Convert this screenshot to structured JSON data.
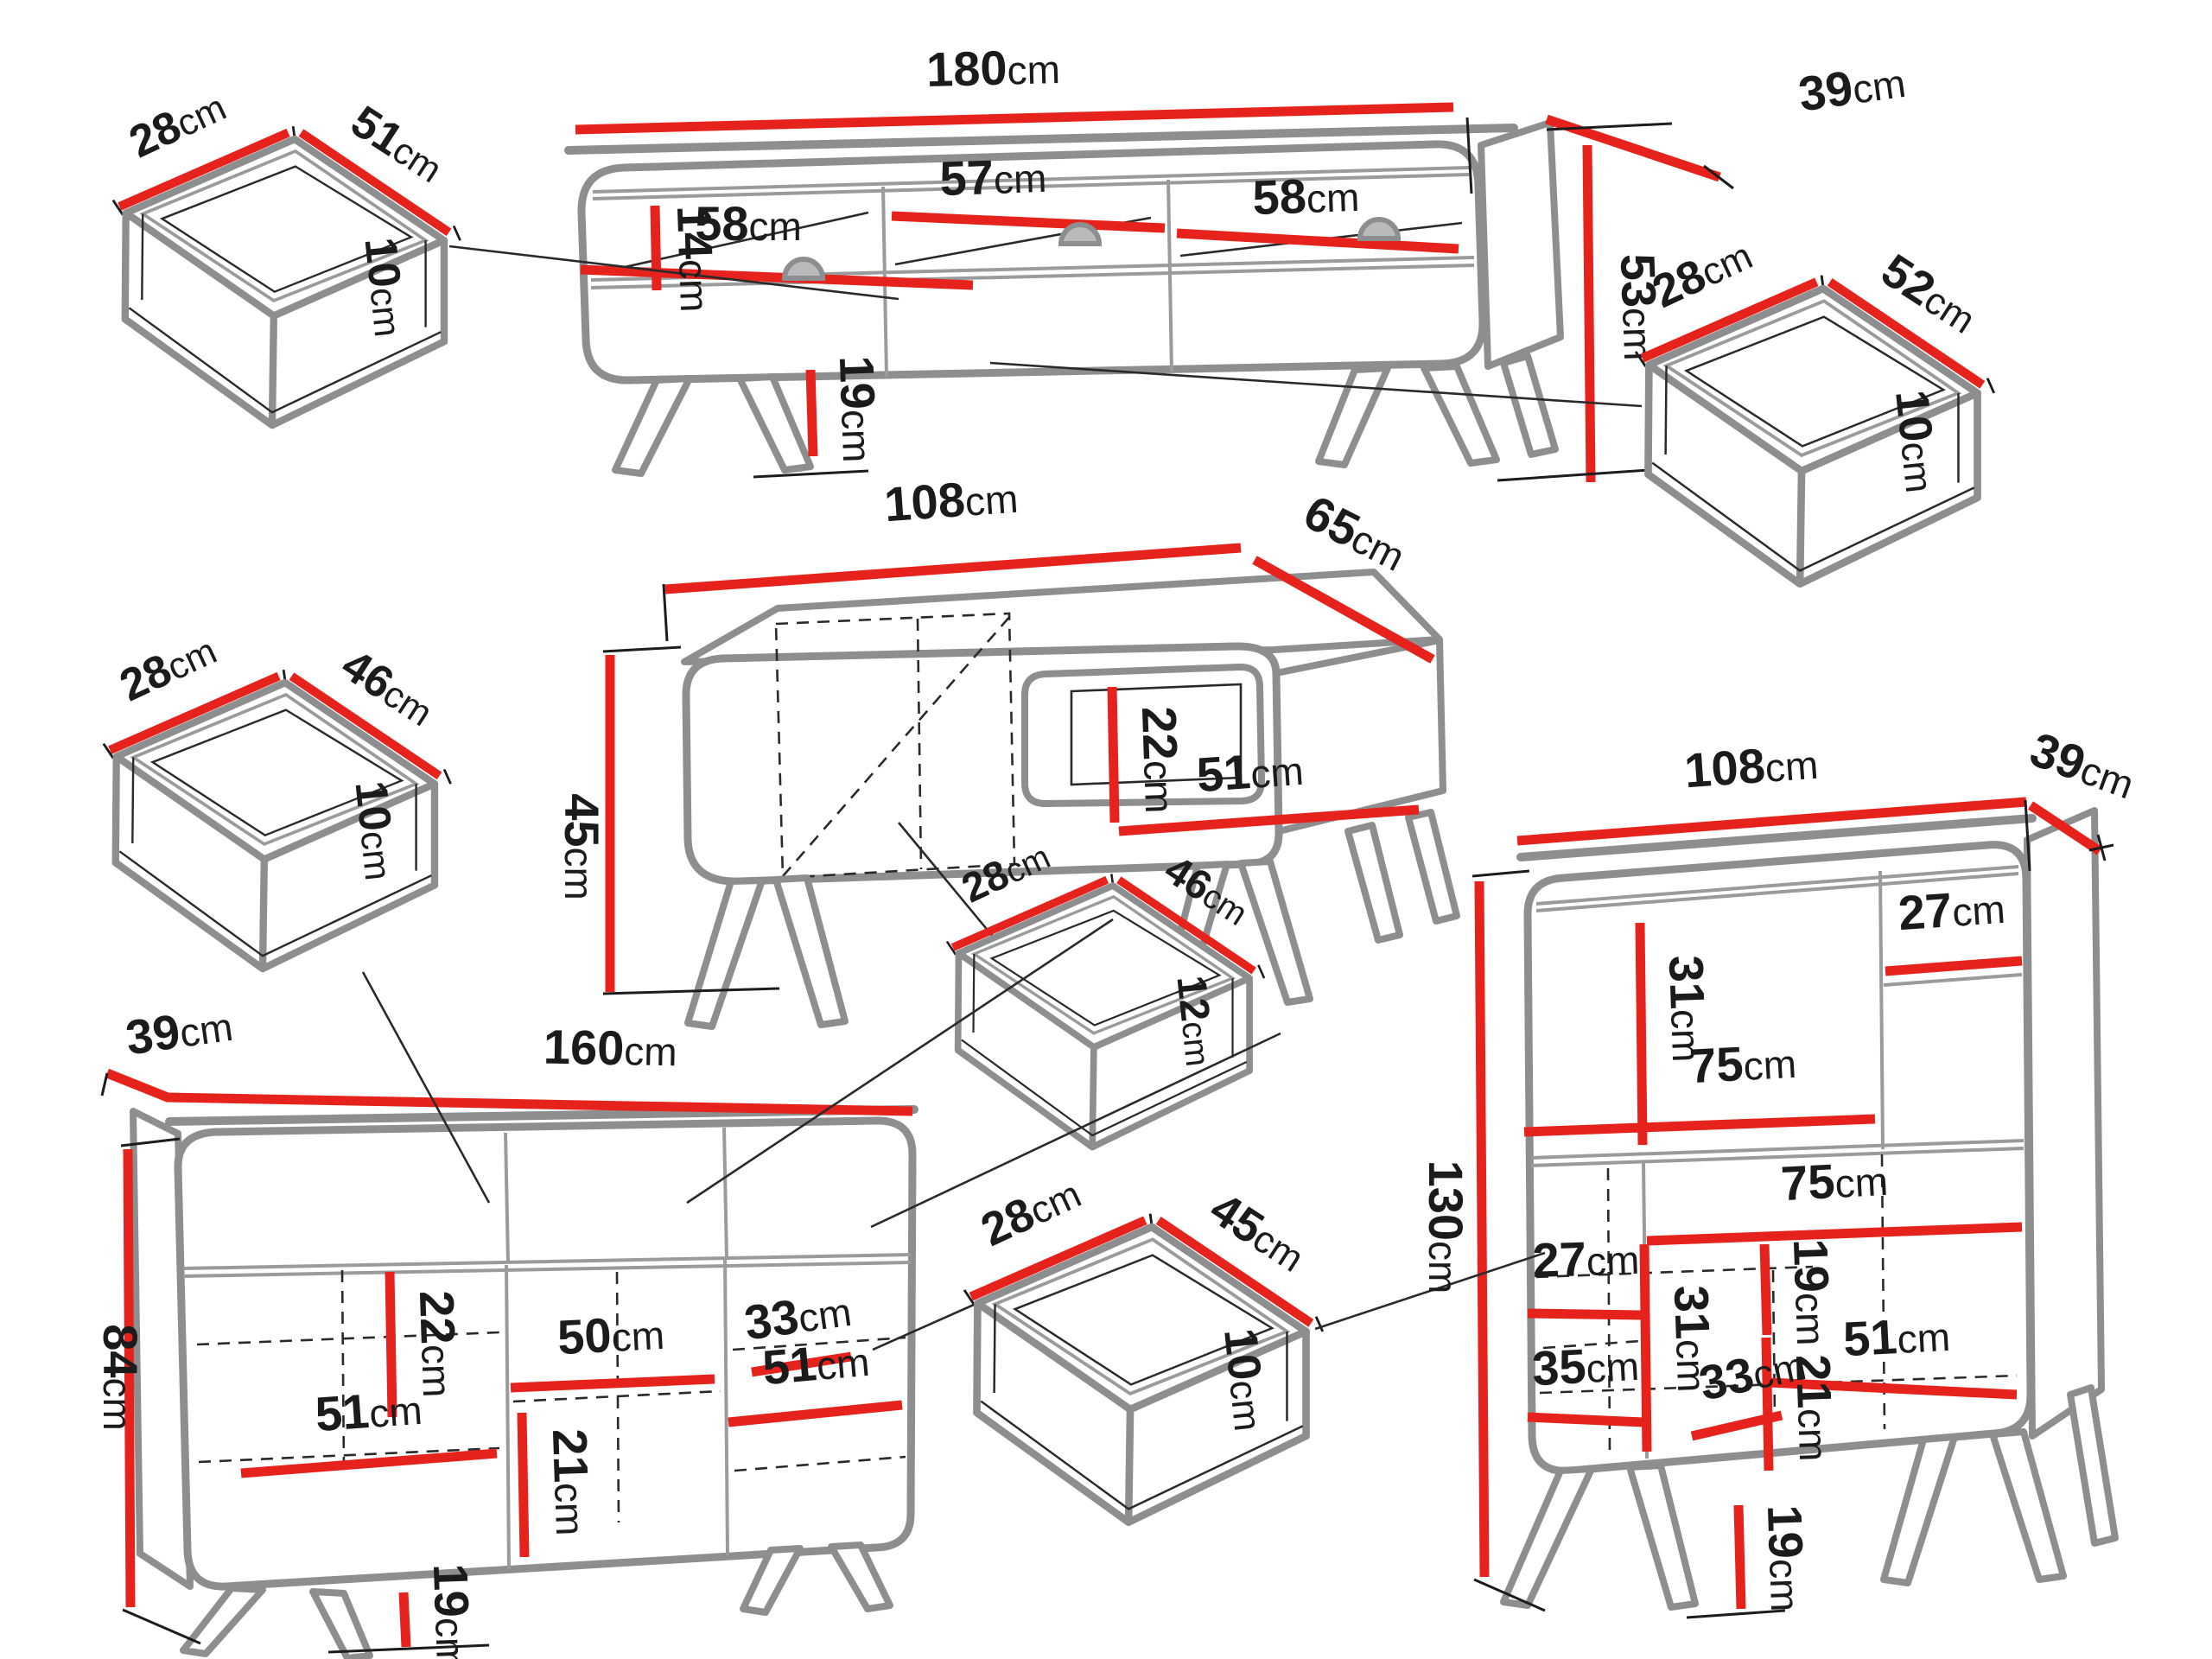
{
  "diagram": {
    "unit": "cm",
    "colors": {
      "dimension_line": "#e5231c",
      "furniture_outline": "#8d8e90",
      "label_text": "#1b1b1c",
      "background": "#ffffff"
    },
    "pieces": {
      "tv_stand": {
        "width": {
          "v": "180",
          "u": "cm"
        },
        "depth": {
          "v": "39",
          "u": "cm"
        },
        "height": {
          "v": "53",
          "u": "cm"
        },
        "niche_height": {
          "v": "14",
          "u": "cm"
        },
        "left_niche": {
          "v": "58",
          "u": "cm"
        },
        "middle_niche": {
          "v": "57",
          "u": "cm"
        },
        "right_niche": {
          "v": "58",
          "u": "cm"
        },
        "leg_height": {
          "v": "19",
          "u": "cm"
        }
      },
      "drawer_top_left": {
        "depth": {
          "v": "28",
          "u": "cm"
        },
        "width": {
          "v": "51",
          "u": "cm"
        },
        "height": {
          "v": "10",
          "u": "cm"
        }
      },
      "drawer_top_right": {
        "depth": {
          "v": "28",
          "u": "cm"
        },
        "width": {
          "v": "52",
          "u": "cm"
        },
        "height": {
          "v": "10",
          "u": "cm"
        }
      },
      "coffee_table": {
        "width": {
          "v": "108",
          "u": "cm"
        },
        "depth": {
          "v": "65",
          "u": "cm"
        },
        "height": {
          "v": "45",
          "u": "cm"
        },
        "niche_height": {
          "v": "22",
          "u": "cm"
        },
        "niche_width": {
          "v": "51",
          "u": "cm"
        }
      },
      "drawer_mid_left": {
        "depth": {
          "v": "28",
          "u": "cm"
        },
        "width": {
          "v": "46",
          "u": "cm"
        },
        "height": {
          "v": "10",
          "u": "cm"
        }
      },
      "drawer_mid_center": {
        "depth": {
          "v": "28",
          "u": "cm"
        },
        "width": {
          "v": "46",
          "u": "cm"
        },
        "height": {
          "v": "12",
          "u": "cm"
        }
      },
      "sideboard": {
        "depth": {
          "v": "39",
          "u": "cm"
        },
        "width": {
          "v": "160",
          "u": "cm"
        },
        "height": {
          "v": "84",
          "u": "cm"
        },
        "niche_height": {
          "v": "22",
          "u": "cm"
        },
        "middle_shelf": {
          "v": "50",
          "u": "cm"
        },
        "right_top_width": {
          "v": "33",
          "u": "cm"
        },
        "left_shelf": {
          "v": "51",
          "u": "cm"
        },
        "middle_niche_height": {
          "v": "21",
          "u": "cm"
        },
        "right_shelf": {
          "v": "51",
          "u": "cm"
        },
        "leg_height": {
          "v": "19",
          "u": "cm"
        }
      },
      "drawer_bottom_center": {
        "depth": {
          "v": "28",
          "u": "cm"
        },
        "width": {
          "v": "45",
          "u": "cm"
        },
        "height": {
          "v": "10",
          "u": "cm"
        }
      },
      "bookcase": {
        "width": {
          "v": "108",
          "u": "cm"
        },
        "depth": {
          "v": "39",
          "u": "cm"
        },
        "height": {
          "v": "130",
          "u": "cm"
        },
        "upper_niche_height": {
          "v": "31",
          "u": "cm"
        },
        "upper_right_width": {
          "v": "27",
          "u": "cm"
        },
        "upper_shelf": {
          "v": "75",
          "u": "cm"
        },
        "middle_shelf": {
          "v": "75",
          "u": "cm"
        },
        "lower_left_width": {
          "v": "27",
          "u": "cm"
        },
        "middle_niche_height": {
          "v": "31",
          "u": "cm"
        },
        "corner_width": {
          "v": "33",
          "u": "cm"
        },
        "lower_left_shelf": {
          "v": "35",
          "u": "cm"
        },
        "lower_niche_height": {
          "v": "19",
          "u": "cm"
        },
        "lower_shelf": {
          "v": "51",
          "u": "cm"
        },
        "bottom_niche_height": {
          "v": "21",
          "u": "cm"
        },
        "leg_height": {
          "v": "19",
          "u": "cm"
        }
      }
    }
  }
}
